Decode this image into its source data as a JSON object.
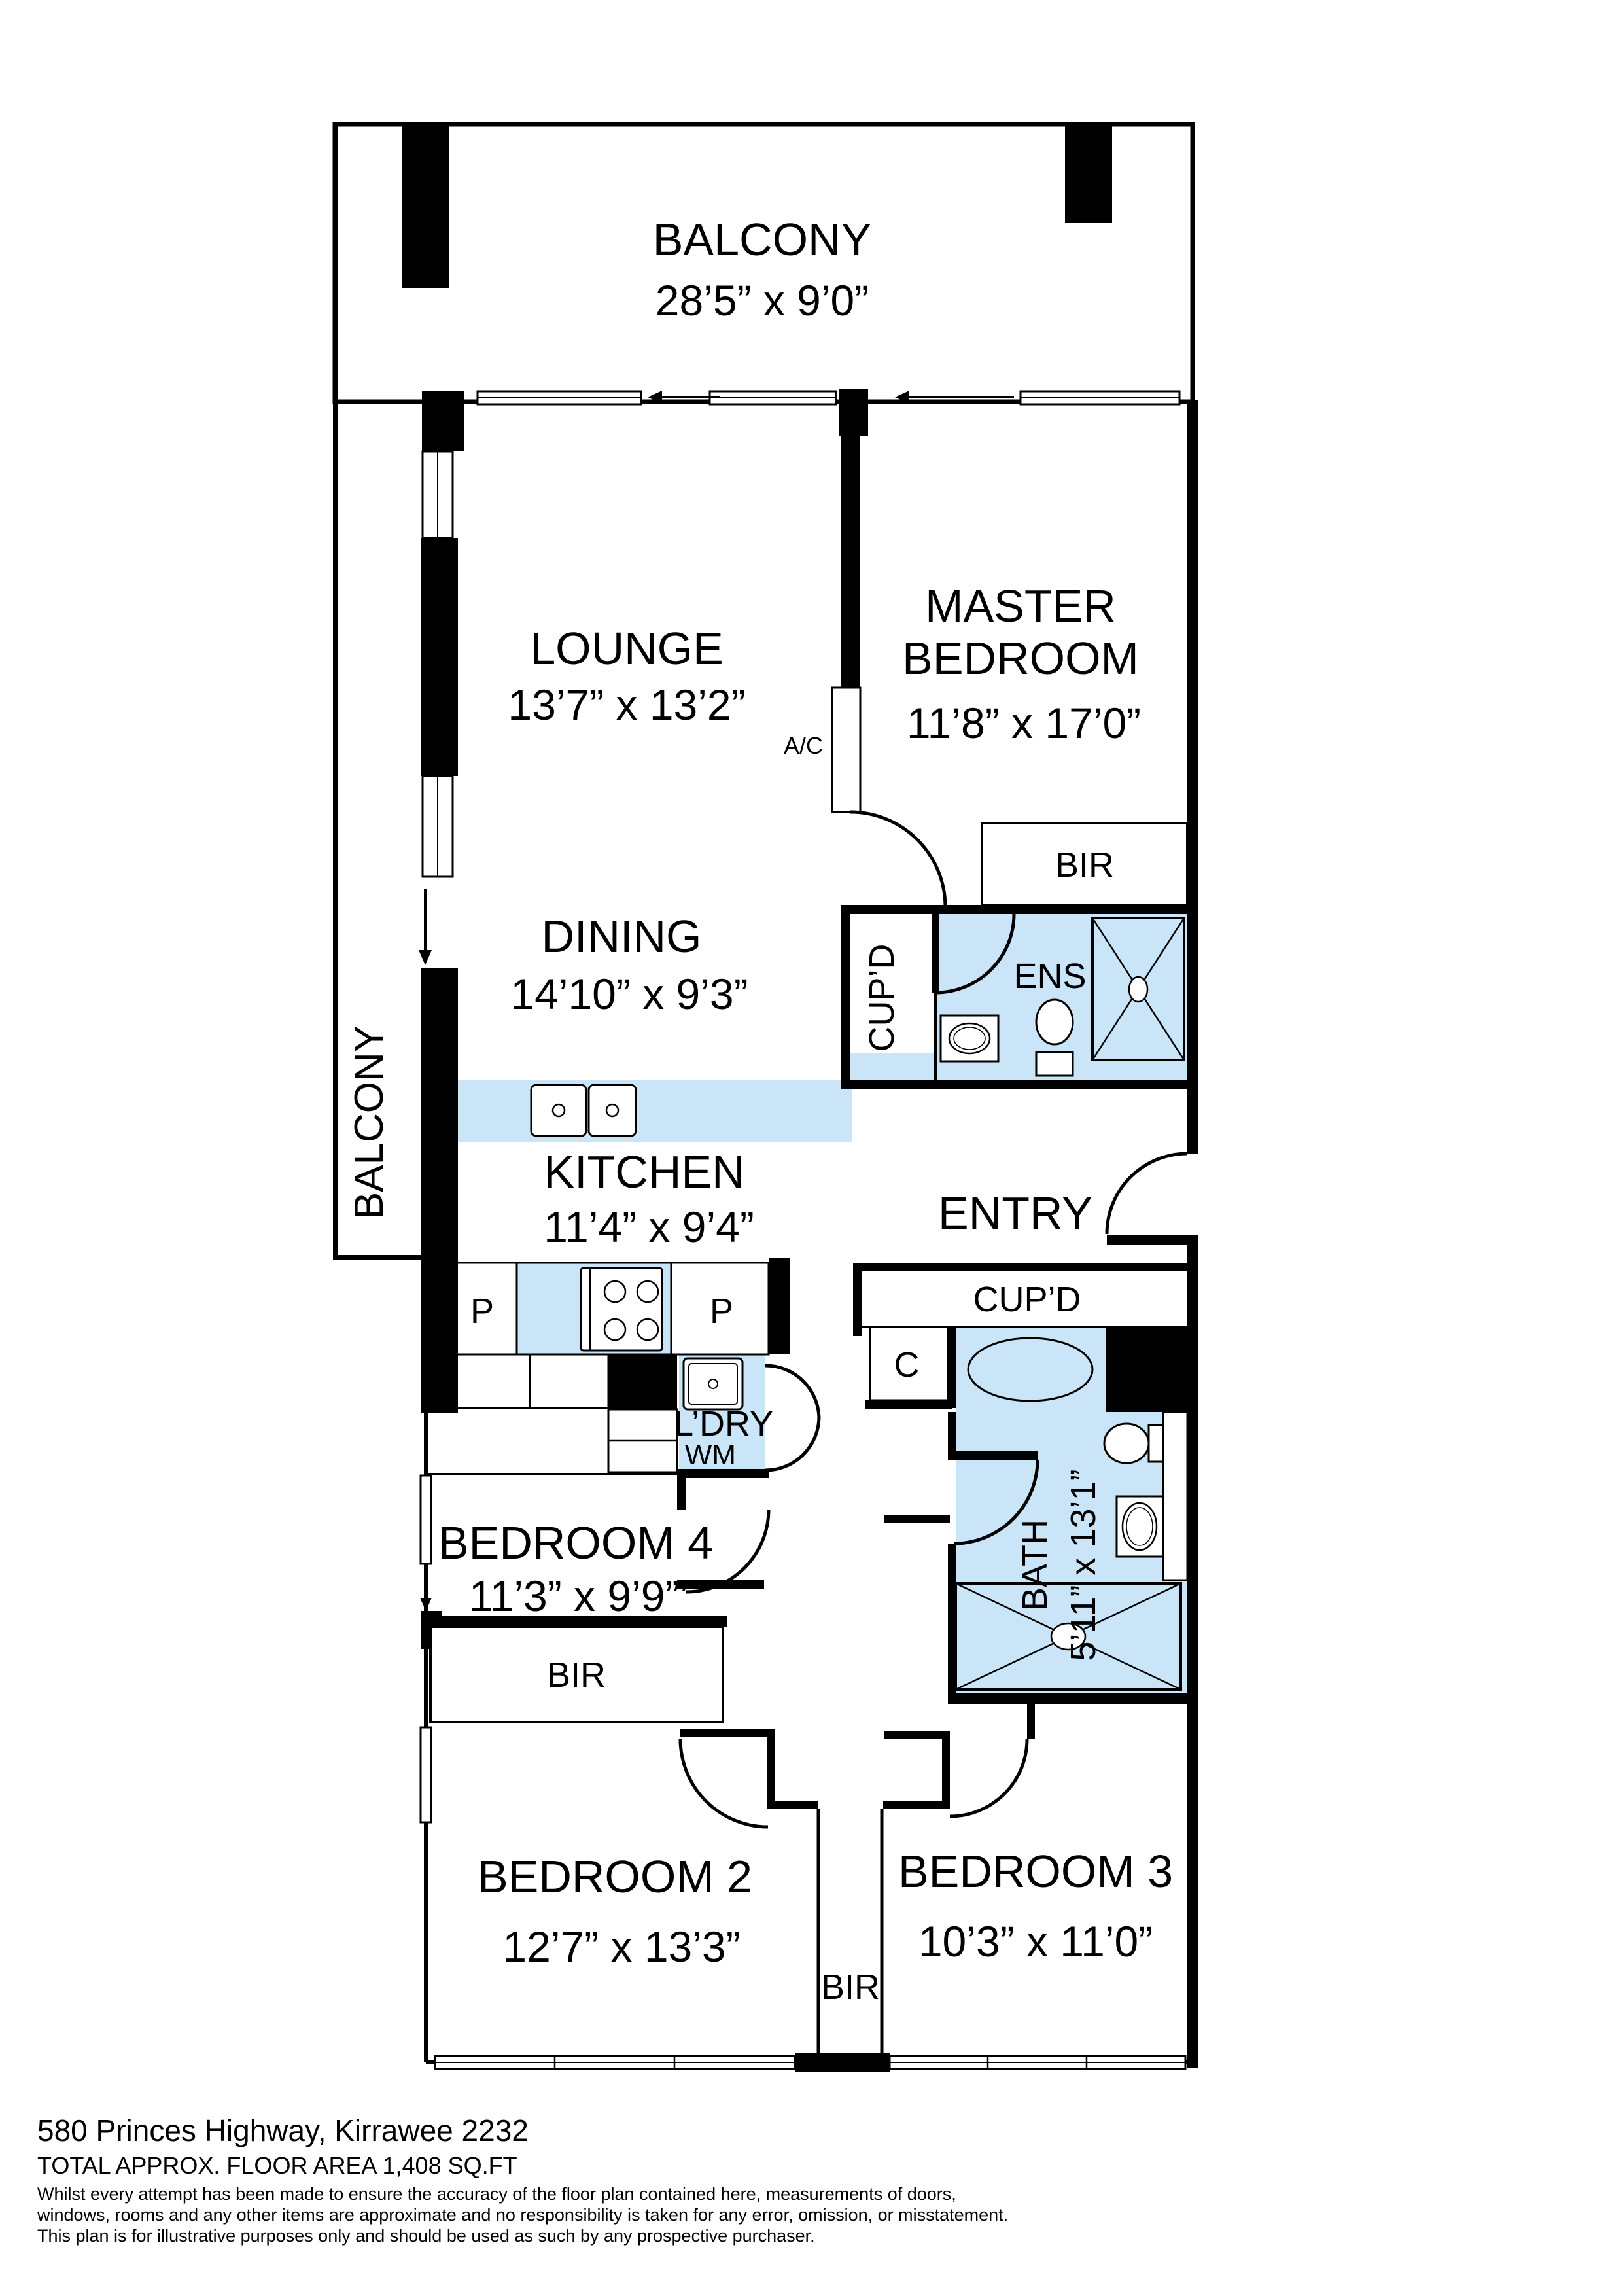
{
  "plan": {
    "colors": {
      "wet_fill": "#C9E5F7",
      "wall": "#000000",
      "background": "#FFFFFF"
    },
    "rooms": {
      "balcony_top": {
        "name": "BALCONY",
        "dims": "28’5” x 9’0”"
      },
      "balcony_left": {
        "name": "BALCONY"
      },
      "lounge": {
        "name": "LOUNGE",
        "dims": "13’7” x 13’2”"
      },
      "master_bedroom": {
        "name_line1": "MASTER",
        "name_line2": "BEDROOM",
        "dims": "11’8” x 17’0”"
      },
      "dining": {
        "name": "DINING",
        "dims": "14’10” x 9’3”"
      },
      "kitchen": {
        "name": "KITCHEN",
        "dims": "11’4” x 9’4”"
      },
      "entry": {
        "name": "ENTRY"
      },
      "ensuite": {
        "name": "ENS"
      },
      "bath": {
        "name": "BATH",
        "dims": "5’11” x 13’1”"
      },
      "laundry": {
        "name": "L’DRY"
      },
      "bedroom2": {
        "name": "BEDROOM 2",
        "dims": "12’7” x 13’3”"
      },
      "bedroom3": {
        "name": "BEDROOM 3",
        "dims": "10’3” x 11’0”"
      },
      "bedroom4": {
        "name": "BEDROOM 4",
        "dims": "11’3” x 9’9”’"
      }
    },
    "fixtures": {
      "ac": "A/C",
      "wm": "WM",
      "master_bir": "BIR",
      "bedroom2_bir": "BIR",
      "bedroom23_bir": "BIR",
      "ens_cupboard": "CUP’D",
      "entry_cupboard": "CUP’D",
      "hall_cupboard": "C",
      "pantry_left": "P",
      "pantry_right": "P"
    }
  },
  "footer": {
    "address": "580 Princes Highway, Kirrawee 2232",
    "area": "TOTAL APPROX. FLOOR AREA 1,408 SQ.FT",
    "disclaimer_line1": "Whilst every attempt has been made to ensure the accuracy of the floor plan contained here, measurements of doors,",
    "disclaimer_line2": "windows, rooms and any other items are approximate and no responsibility is taken for any error, omission, or misstatement.",
    "disclaimer_line3": "This plan is for illustrative purposes only and should be used as such by any prospective purchaser."
  }
}
